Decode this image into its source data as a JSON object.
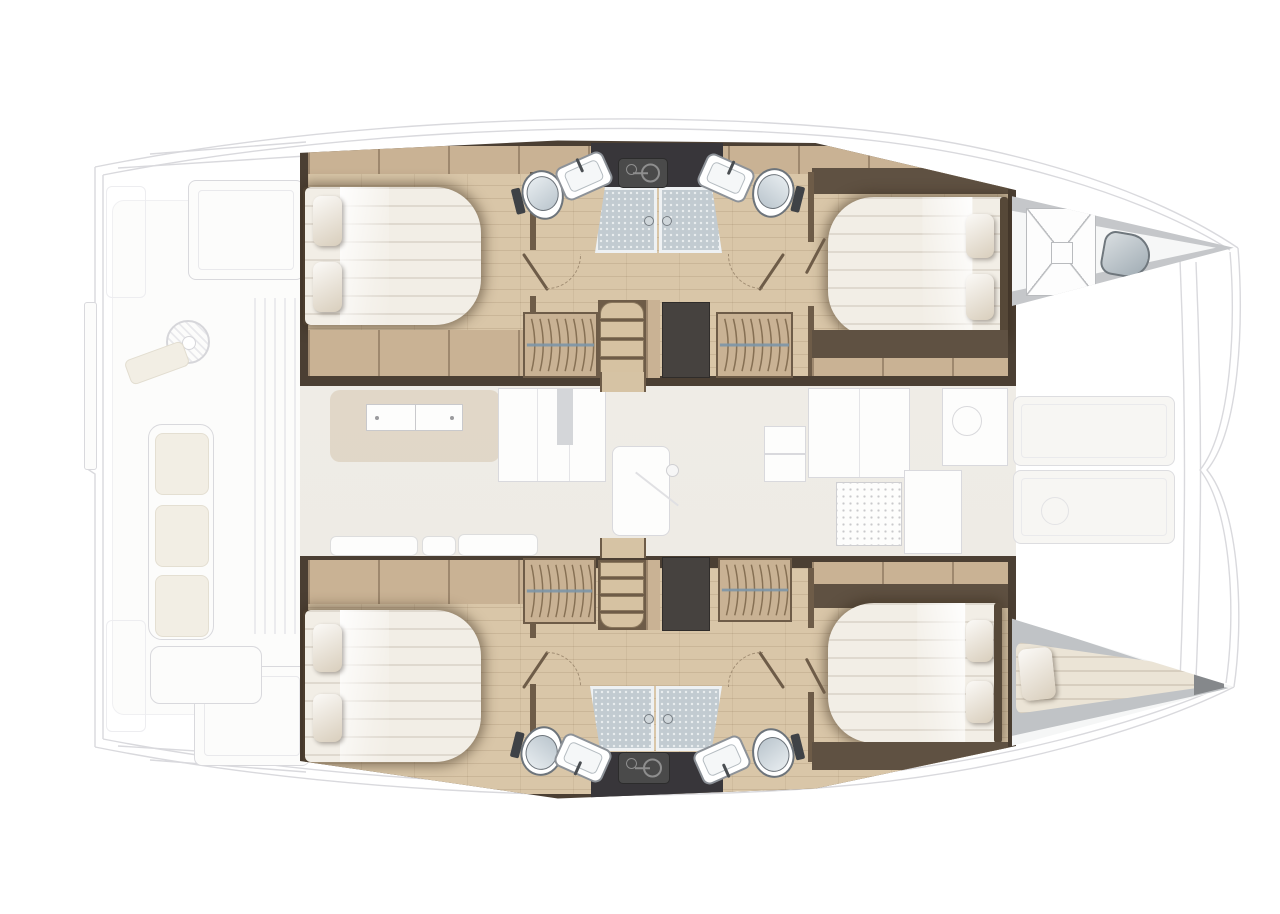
{
  "diagram": {
    "type": "boat-floor-plan",
    "subject": "Catamaran interior layout, top-down view, bow to the right",
    "rendered_text": [],
    "areas": {
      "aft_cockpit": {
        "label": "aft cockpit (ghosted)",
        "features": [
          "transom step",
          "deck hatches",
          "helm winch",
          "bench seating",
          "louvered locker",
          "cushions"
        ]
      },
      "saloon": {
        "label": "saloon and galley (ghosted)",
        "features": [
          "sideboard",
          "tall cabinets",
          "entry door with knob",
          "sofa cushions",
          "fridge",
          "stove",
          "round sink",
          "counters"
        ]
      },
      "port_hull_top": {
        "label": "port hull",
        "rooms": [
          "aft double cabin",
          "aft bathroom",
          "two shower stalls",
          "forward bathroom",
          "forward double cabin"
        ],
        "features": [
          "two wardrobes",
          "companionway stairs",
          "dark technical locker",
          "appliance panel"
        ]
      },
      "starboard_hull_bottom": {
        "label": "starboard hull",
        "rooms": [
          "aft double cabin",
          "aft bathroom",
          "two shower stalls",
          "forward bathroom",
          "forward double cabin"
        ],
        "features": [
          "two wardrobes",
          "companionway stairs",
          "dark technical locker",
          "appliance panel"
        ]
      },
      "port_bow": {
        "label": "port bow compartment",
        "features": [
          "cross-braced hatch",
          "round seat"
        ]
      },
      "starboard_bow": {
        "label": "starboard bow skipper berth",
        "features": [
          "tapered single berth",
          "pillow"
        ]
      },
      "foredeck": {
        "label": "foredeck",
        "features": [
          "two locker lids",
          "windlass outline",
          "crossbeam"
        ]
      }
    },
    "counts": {
      "double_beds": 4,
      "single_berths": 1,
      "toilets": 4,
      "washbasins": 4,
      "shower_stalls": 4,
      "wardrobes": 4,
      "staircases": 2,
      "bow_hatches": 1,
      "foredeck_lockers": 2
    }
  },
  "colors": {
    "hull_wall": "#4b3f33",
    "wall_mid": "#6e5c48",
    "wood_dark": "#5f5142",
    "wood_band": "#c9b294",
    "floor": "#d9c6a8",
    "bed": "#f2eee6",
    "pillow": "#ece4d6",
    "headboard": "#564838",
    "shower": "#c2cbd1",
    "toilet_lid": "#b9c4cc",
    "fixture_line": "#6d747b",
    "dark_panel": "#4a4a4a",
    "dark_top": "#38363a",
    "closet": "#46423f",
    "rod": "#7d96a8",
    "hanger": "#7b6549",
    "ghost_line": "#d9d9dd",
    "ghost_fill": "#fcfcfb",
    "ghost_cushion": "#f2eee4",
    "saloon_bg": "#eeebe5",
    "deck_gray": "#c5c7ca",
    "bow_inner": "#c0c3c6",
    "berth": "#ebe4d6",
    "arc": "#a08c72"
  }
}
